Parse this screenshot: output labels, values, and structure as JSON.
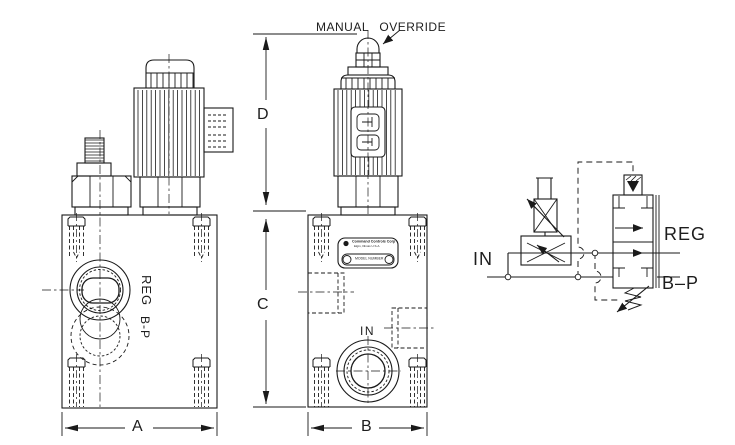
{
  "annotations": {
    "manual_override": "MANUAL OVERRIDE"
  },
  "dimensions": {
    "a": "A",
    "b": "B",
    "c": "C",
    "d": "D"
  },
  "front_view": {
    "reg_label": "REG",
    "bp_label": "B-P"
  },
  "side_view": {
    "in_label": "IN",
    "nameplate": {
      "brand": "Command Controls Corp",
      "location": "Elgin, Illinois U.S.A.",
      "model": "MODEL NUMBER"
    }
  },
  "schematic": {
    "in_label": "IN",
    "reg_label": "REG",
    "bp_label": "B–P"
  },
  "colors": {
    "ink": "#1a1a1a",
    "paper": "#ffffff"
  }
}
